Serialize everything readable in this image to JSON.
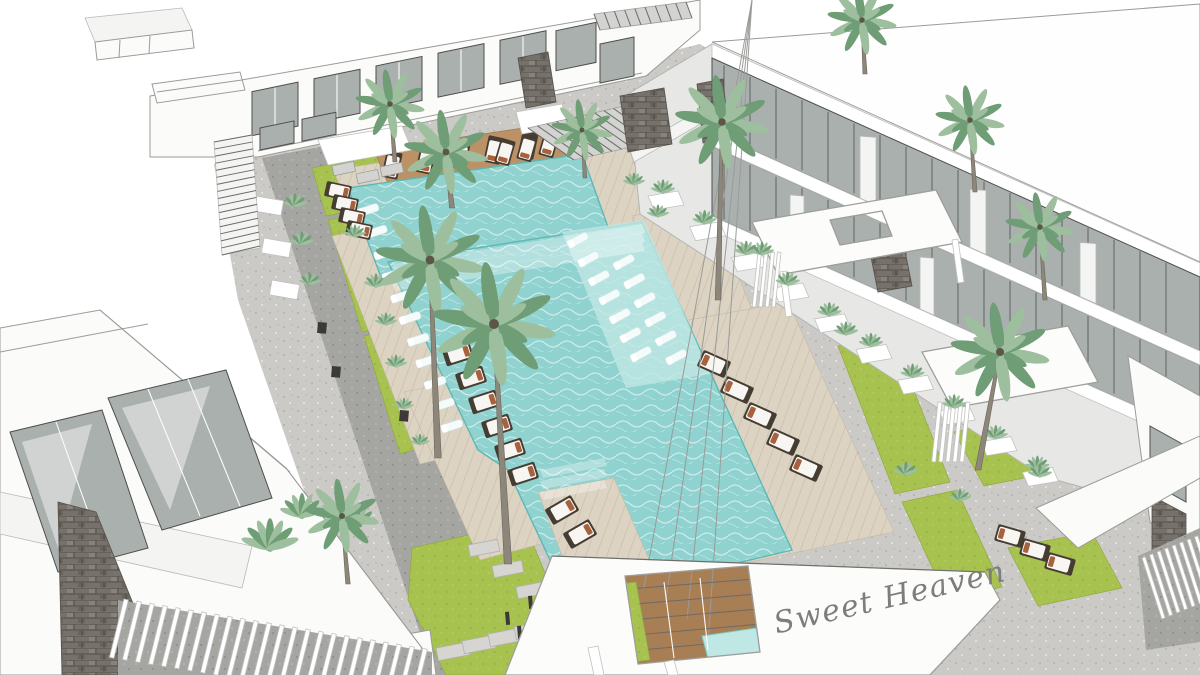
{
  "scene": {
    "type": "3d-architectural-rendering",
    "subject": "aerial view of a resort apartment courtyard with swimming pools, sun loungers and palm trees",
    "watermark": {
      "text": "Sweet Heaven"
    }
  },
  "watermark": {
    "text": "Sweet Heaven"
  },
  "colors": {
    "sky": "#ffffff",
    "pavement": "#cbcac6",
    "pavement_dark": "#a5a5a2",
    "grass": "#a7c24f",
    "deck_wood": "#dcd3c3",
    "island_wood": "#bd9166",
    "pool_water": "#8fd2cf",
    "pool_water_light": "#bfe7e4",
    "pool_edge": "#5fb7b4",
    "wall_white": "#fbfbfa",
    "facade_gray": "#e7e7e5",
    "window_glass": "#a9b0ae",
    "window_frame": "#4e4e4c",
    "stone_dark": "#76716a",
    "palm_green": "#6f9d76",
    "palm_green_light": "#9dbf9e",
    "palm_trunk": "#8d867a",
    "lounger_frame": "#453c32",
    "lounger_cushion": "#f7f6f3",
    "lounger_pillow": "#a8613d",
    "outline": "#9b9b98",
    "watermark_color": "#7d7d7b"
  }
}
